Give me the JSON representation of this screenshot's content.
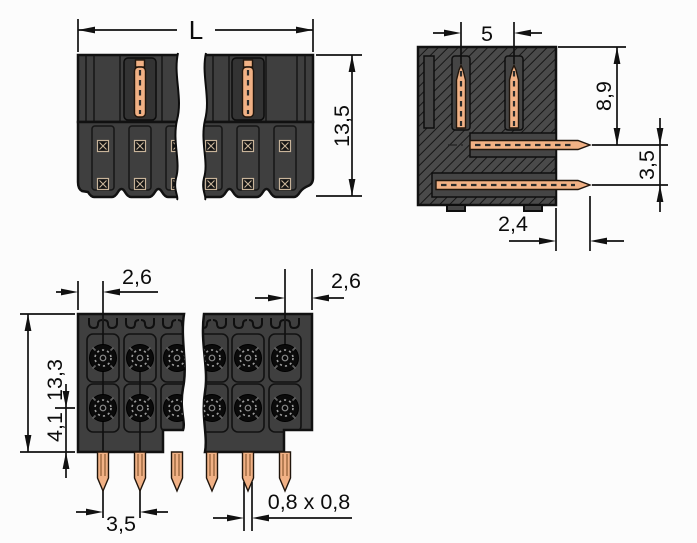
{
  "labels": {
    "front": {
      "width": "L",
      "height": "13,5"
    },
    "side": {
      "pin_pitch": "5",
      "pin_depth": "8,9",
      "row_pitch": "3,5",
      "pin_offset": "2,4"
    },
    "bottom": {
      "left_margin": "2,6",
      "right_margin": "2,6",
      "depth": "13,3",
      "row_offset": "4,1",
      "pitch": "3,5",
      "pin_size": "0,8 x 0,8"
    }
  },
  "colors": {
    "background": "#fcfcfc",
    "body_fill": "#3f3f3f",
    "outline": "#111111",
    "copper": "#f1b185",
    "dimension_lines": "#111111"
  }
}
